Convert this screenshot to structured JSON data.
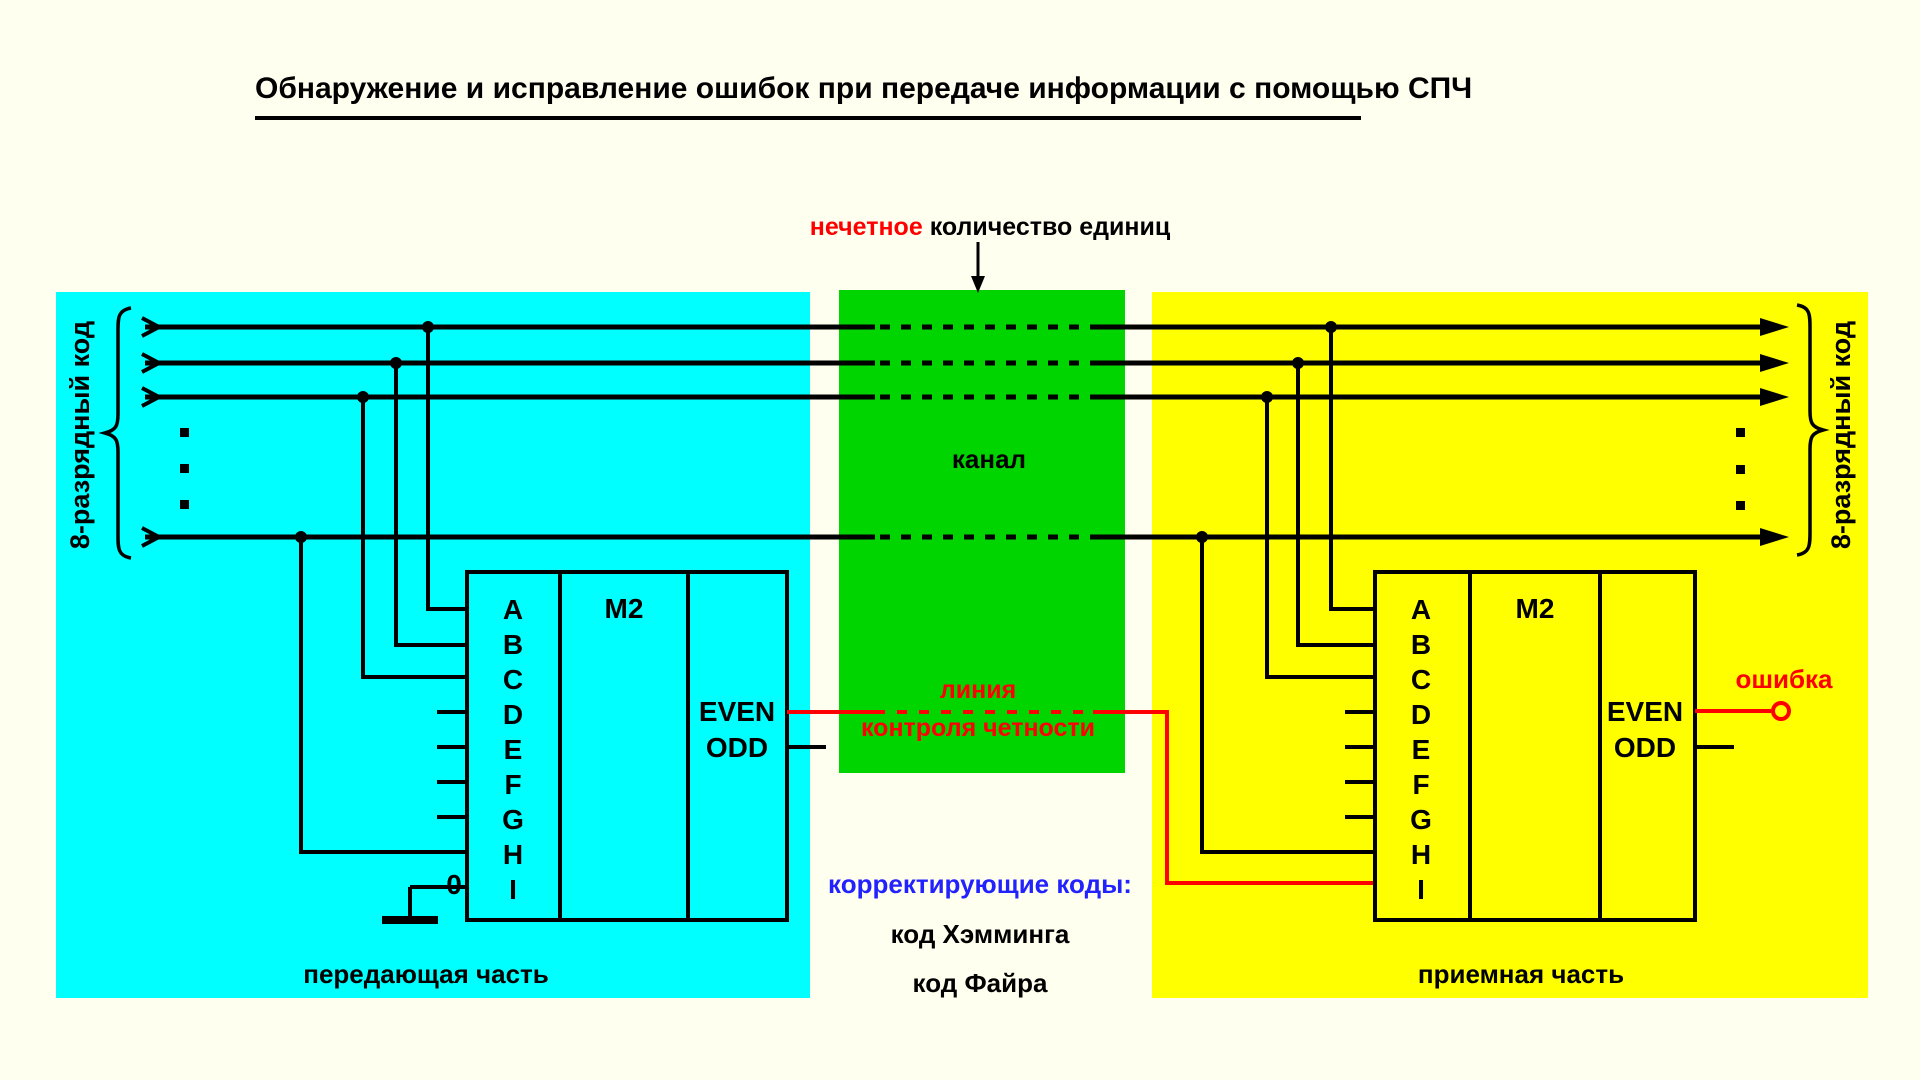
{
  "title": {
    "text": "Обнаружение и исправление ошибок при передаче информации с помощью СПЧ"
  },
  "top_annotation": {
    "highlight": "нечетное",
    "rest": "количество единиц"
  },
  "channel": {
    "label": "канал"
  },
  "parity_line_label": {
    "line1": "линия",
    "line2": "контроля четности"
  },
  "correcting_codes": {
    "heading": "корректирующие коды:",
    "items": [
      "код Хэмминга",
      "код Файра"
    ]
  },
  "transmitter": {
    "caption": "передающая часть",
    "bus_label": "8-разрядный код",
    "block": {
      "name": "M2",
      "pins": [
        "A",
        "B",
        "C",
        "D",
        "E",
        "F",
        "G",
        "H",
        "I"
      ],
      "even": "EVEN",
      "odd": "ODD",
      "zero_input": "0"
    }
  },
  "receiver": {
    "caption": "приемная часть",
    "bus_label": "8-разрядный код",
    "block": {
      "name": "M2",
      "pins": [
        "A",
        "B",
        "C",
        "D",
        "E",
        "F",
        "G",
        "H",
        "I"
      ],
      "even": "EVEN",
      "odd": "ODD"
    },
    "error_label": "ошибка"
  },
  "colors": {
    "background": "#FFFFF0",
    "transmitter_box": "#00FFFF",
    "channel_box": "#00D500",
    "receiver_box": "#FFFF00",
    "accent_red": "#FF0000",
    "codes_blue": "#2222FF",
    "line_black": "#000000"
  }
}
